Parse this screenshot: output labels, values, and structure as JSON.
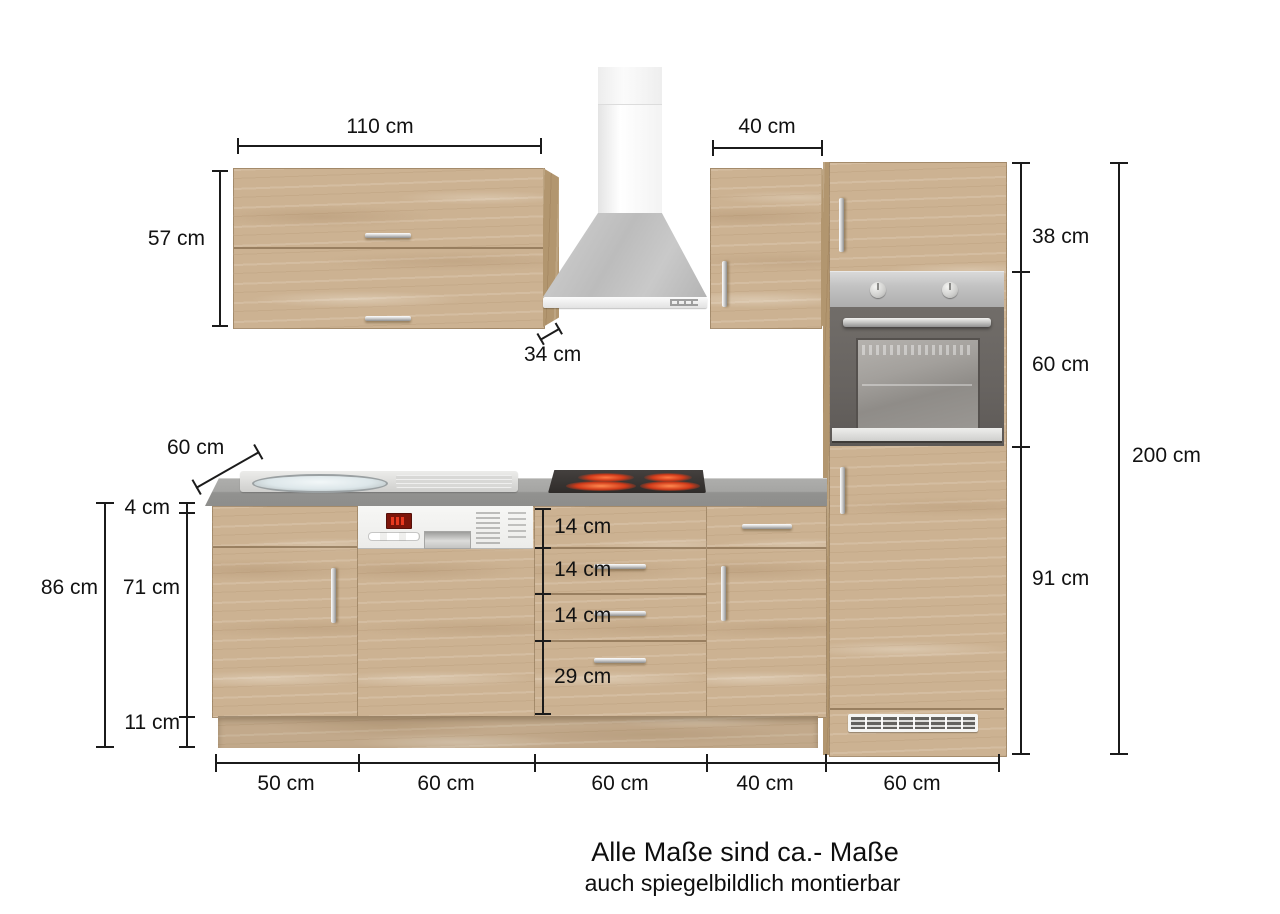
{
  "labels": {
    "wall_width": "110 cm",
    "wall_height": "57 cm",
    "wall_depth": "34 cm",
    "upper_right_width": "40 cm",
    "tall_door_height": "38 cm",
    "oven_height": "60 cm",
    "tall_lower_height": "91 cm",
    "tall_total_height": "200 cm",
    "counter_depth": "60 cm",
    "counter_thickness": "4 cm",
    "base_total_height": "86 cm",
    "base_door_height": "71 cm",
    "plinth_height": "11 cm",
    "drawers": [
      "14 cm",
      "14 cm",
      "14 cm",
      "29 cm"
    ],
    "base_widths": [
      "50 cm",
      "60 cm",
      "60 cm",
      "40 cm",
      "60 cm"
    ]
  },
  "footer": {
    "line1": "Alle Maße sind ca.- Maße",
    "line2": "auch spiegelbildlich montierbar"
  },
  "colors": {
    "wood": "#ccb292",
    "counter_gray": "#9a9a98",
    "dimension_black": "#1b1b1b",
    "burner_red": "#d23b1a"
  }
}
